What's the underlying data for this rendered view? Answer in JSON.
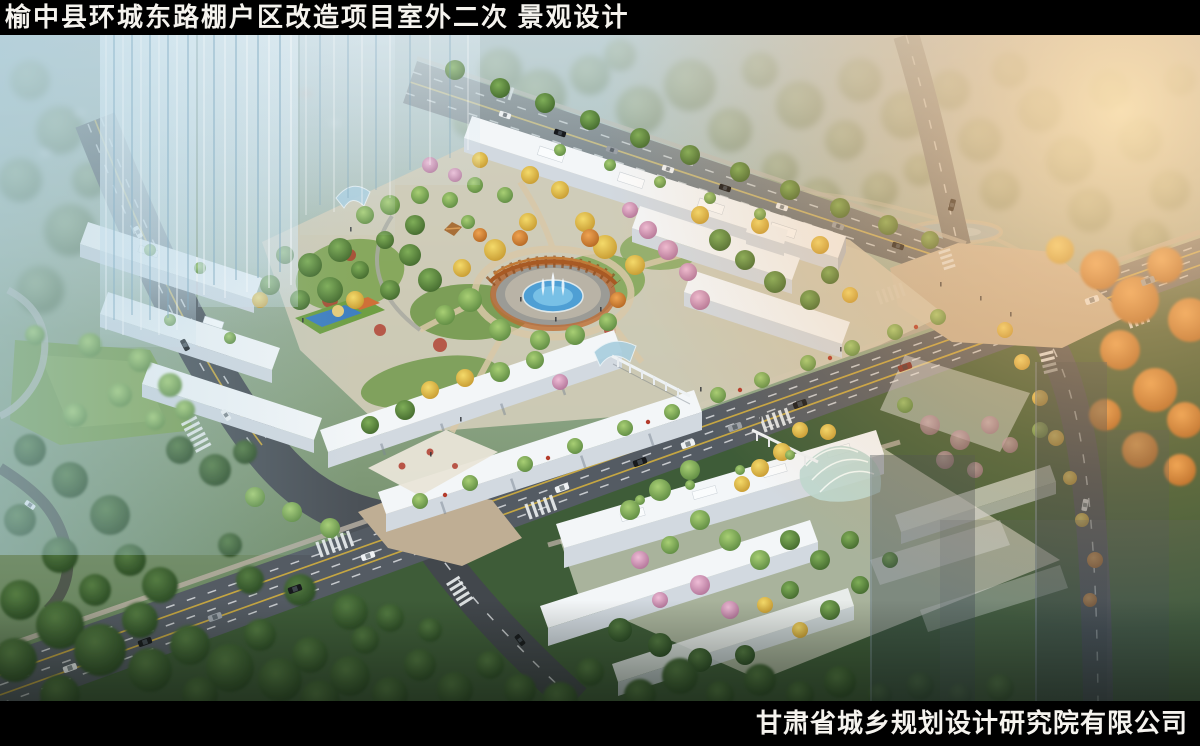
{
  "header": {
    "title": "榆中县环城东路棚户区改造项目室外二次 景观设计"
  },
  "footer": {
    "company": "甘肃省城乡规划设计研究院有限公司"
  },
  "palette": {
    "bar": "#000000",
    "bar_text": "#f5f3ee",
    "sky_cool": "#9ec3d6",
    "sky_warm": "#f6bd85",
    "asphalt": "#4b5157",
    "lane_yellow": "#d9b43c",
    "plaza_tan": "#c6b59a",
    "building_white": "#f3f6f8",
    "water_blue": "#58aede",
    "pergola_rust": "#b2622a",
    "foliage_green": "#5d8a3e",
    "foliage_autumn": "#e0a44a",
    "foliage_pink": "#dba8c6",
    "park_dark": "#3a5634"
  }
}
